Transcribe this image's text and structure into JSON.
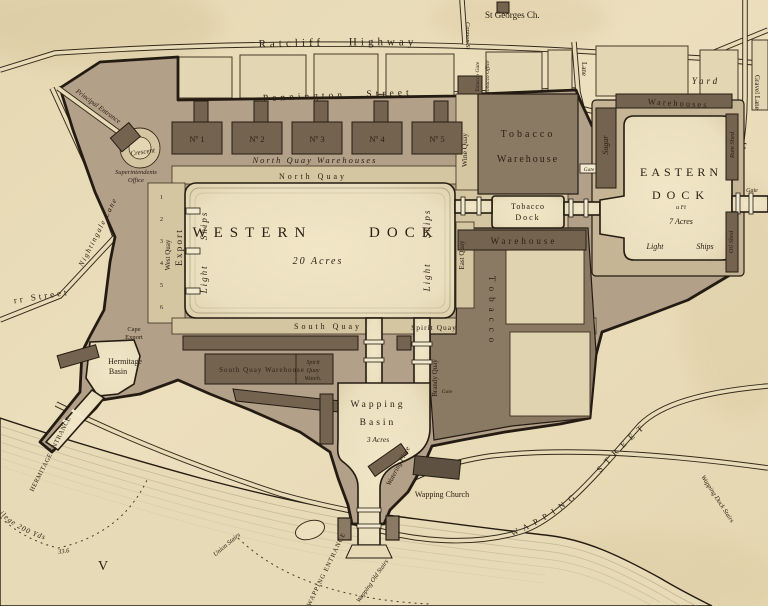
{
  "palette": {
    "paper": "#e9ddbb",
    "estate_land": "#b2a089",
    "eastern_ring": "#c6b595",
    "quay": "#d5c6a2",
    "dock_water": "#ece0bf",
    "warehouse_dark": "#74644f",
    "warehouse_mid": "#8a7a64",
    "ink_line": "#2b2114",
    "river": "#e7dab6"
  },
  "top": {
    "st_georges_church": "St Georges Ch.",
    "ratcliff_highway": "Ratcliff  Highway",
    "cannon_street": "Cannon St",
    "pennington_street": "Pennington  Street",
    "lane": "Lane",
    "gravel_lane": "Gravel Lane",
    "tobacco_gate": "Tobacco Gate",
    "tobacco_office": "Tobacco Office"
  },
  "western_dock": {
    "name": "WESTERN DOCK",
    "acreage": "20 Acres",
    "north_quay": "North Quay",
    "south_quay": "South Quay",
    "west_quay": "West Quay",
    "export_quay": "Export",
    "light_ships_west": "Light Ships",
    "light_ships_east": "Light Ships",
    "berths": [
      "1",
      "2",
      "3",
      "4",
      "5",
      "6"
    ],
    "warehouse_row": [
      "Nº 1",
      "Nº 2",
      "Nº 3",
      "Nº 4",
      "Nº 5"
    ],
    "north_quay_warehouses": "North Quay Warehouses",
    "crescent": "Crescent",
    "superintendents_office_1": "Superintendents",
    "superintendents_office_2": "Office",
    "principal_entrance": "Principal Entrance"
  },
  "tobacco": {
    "warehouse_1": "Tobacco",
    "warehouse_2": "Warehouse",
    "wine_quay": "Wine Quay",
    "dock_1": "Tobacco",
    "dock_2": "Dock",
    "warehouse_south": "Warehouse",
    "east_quay": "East Quay",
    "ground": "Tobacco",
    "gate": "Gate"
  },
  "eastern_dock": {
    "name_1": "EASTERN",
    "name_2": "DOCK",
    "depth": "u Ft",
    "acreage": "7 Acres",
    "light": "Light",
    "ships": "Ships",
    "warehouses": "Warehouses",
    "sugar": "Sugar",
    "rum_shed": "Rum Shed",
    "oil_shed": "Oil Shed",
    "yard": "Yard",
    "gate": "Gate"
  },
  "south": {
    "south_quay_warehouse": "South Quay Warehouse",
    "spirit_wareh_1": "Spirit",
    "spirit_wareh_2": "Quay",
    "spirit_wareh_3": "Wareh.",
    "spirit_quay": "Spirit Quay",
    "brandy_quay": "Brandy Quay",
    "gate": "Gate"
  },
  "wapping": {
    "basin_1": "Wapping",
    "basin_2": "Basin",
    "acreage": "3 Acres",
    "watering_place": "Watering Place",
    "church": "Wapping Church",
    "entrance": "WAPPING ENTRANCE",
    "old_stairs": "Wapping Old Stairs",
    "dock_stairs": "Wapping Dock Stairs",
    "union_stairs": "Union Stairs",
    "street": "WAPPING STREET"
  },
  "hermitage": {
    "basin_1": "Hermitage",
    "basin_2": "Basin",
    "entrance": "HERMITAGE ENTRANCE",
    "cape_1": "Cape",
    "cape_2": "Export",
    "privilege": "Privilege 200 Yds"
  },
  "west_side": {
    "burr_street": "rr Street",
    "nightingale_lane": "Nightingale Lane"
  },
  "river": {
    "sounding": "33.6",
    "mark": "V"
  }
}
